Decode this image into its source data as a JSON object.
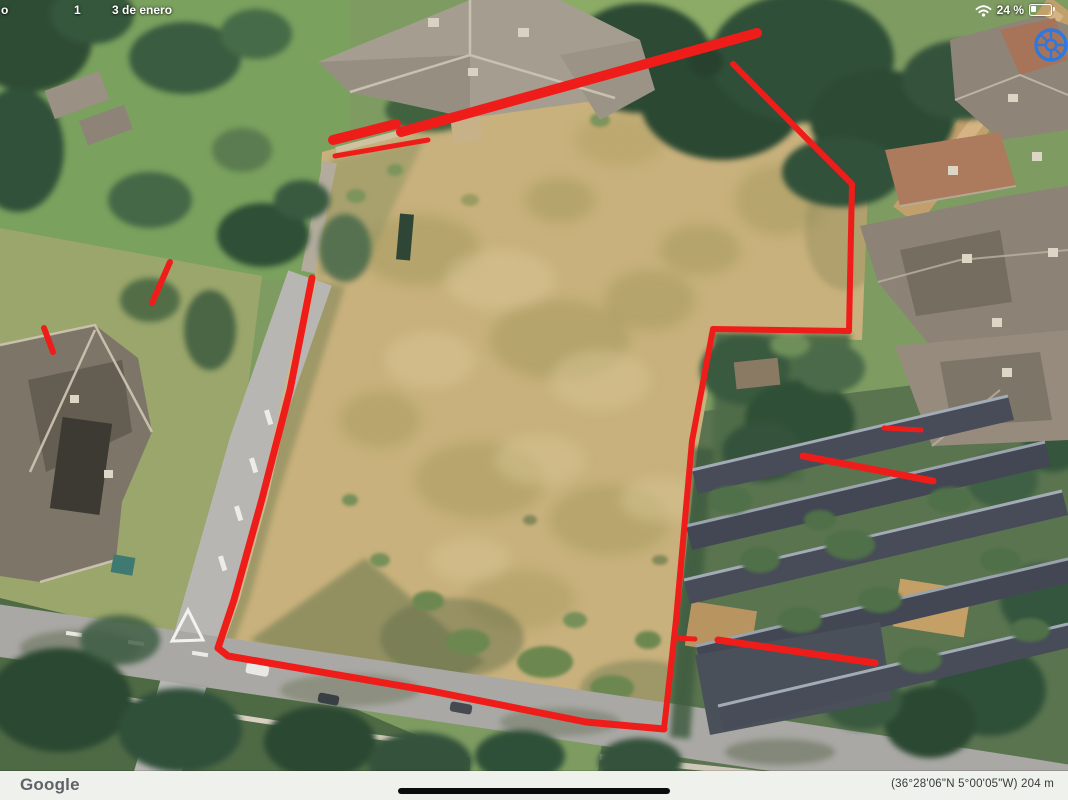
{
  "status_bar": {
    "time_fragment": "o",
    "notification_fragment": "1",
    "date": "3 de enero",
    "battery_percent": "24 %"
  },
  "bottom_bar": {
    "watermark": "Google",
    "coordinates": "(36°28'06\"N 5°00'05\"W) 204 m"
  },
  "annotations": {
    "color": "#ef1d1a",
    "lines": [
      {
        "name": "top-edge-short",
        "width": 10,
        "points": [
          [
            333,
            140
          ],
          [
            396,
            124
          ]
        ]
      },
      {
        "name": "top-edge-long",
        "width": 10,
        "points": [
          [
            401,
            132
          ],
          [
            757,
            33
          ]
        ]
      },
      {
        "name": "top-edge-inner",
        "width": 5,
        "points": [
          [
            335,
            156
          ],
          [
            428,
            140
          ]
        ]
      },
      {
        "name": "right-upper",
        "width": 6,
        "points": [
          [
            733,
            64
          ],
          [
            819,
            151
          ],
          [
            852,
            184
          ],
          [
            849,
            331
          ]
        ]
      },
      {
        "name": "notch-horizontal",
        "width": 6,
        "points": [
          [
            849,
            331
          ],
          [
            713,
            329
          ]
        ]
      },
      {
        "name": "right-lower",
        "width": 6,
        "points": [
          [
            713,
            329
          ],
          [
            692,
            441
          ],
          [
            676,
            620
          ],
          [
            664,
            729
          ]
        ]
      },
      {
        "name": "right-tick",
        "width": 5,
        "points": [
          [
            676,
            638
          ],
          [
            695,
            639
          ]
        ]
      },
      {
        "name": "bottom-edge",
        "width": 7,
        "points": [
          [
            664,
            729
          ],
          [
            586,
            722
          ],
          [
            431,
            691
          ],
          [
            228,
            656
          ],
          [
            218,
            648
          ]
        ]
      },
      {
        "name": "left-edge",
        "width": 7,
        "points": [
          [
            218,
            648
          ],
          [
            234,
            600
          ],
          [
            262,
            499
          ],
          [
            290,
            390
          ],
          [
            312,
            278
          ]
        ]
      },
      {
        "name": "dash-far-left",
        "width": 6,
        "points": [
          [
            44,
            328
          ],
          [
            53,
            352
          ]
        ]
      },
      {
        "name": "dash-left",
        "width": 6,
        "points": [
          [
            170,
            262
          ],
          [
            152,
            303
          ]
        ]
      },
      {
        "name": "dash-right-small",
        "width": 5,
        "points": [
          [
            884,
            428
          ],
          [
            921,
            430
          ]
        ]
      },
      {
        "name": "terrace-line-upper",
        "width": 7,
        "points": [
          [
            803,
            456
          ],
          [
            933,
            481
          ]
        ]
      },
      {
        "name": "terrace-line-lower",
        "width": 7,
        "points": [
          [
            718,
            640
          ],
          [
            875,
            663
          ]
        ]
      }
    ]
  }
}
